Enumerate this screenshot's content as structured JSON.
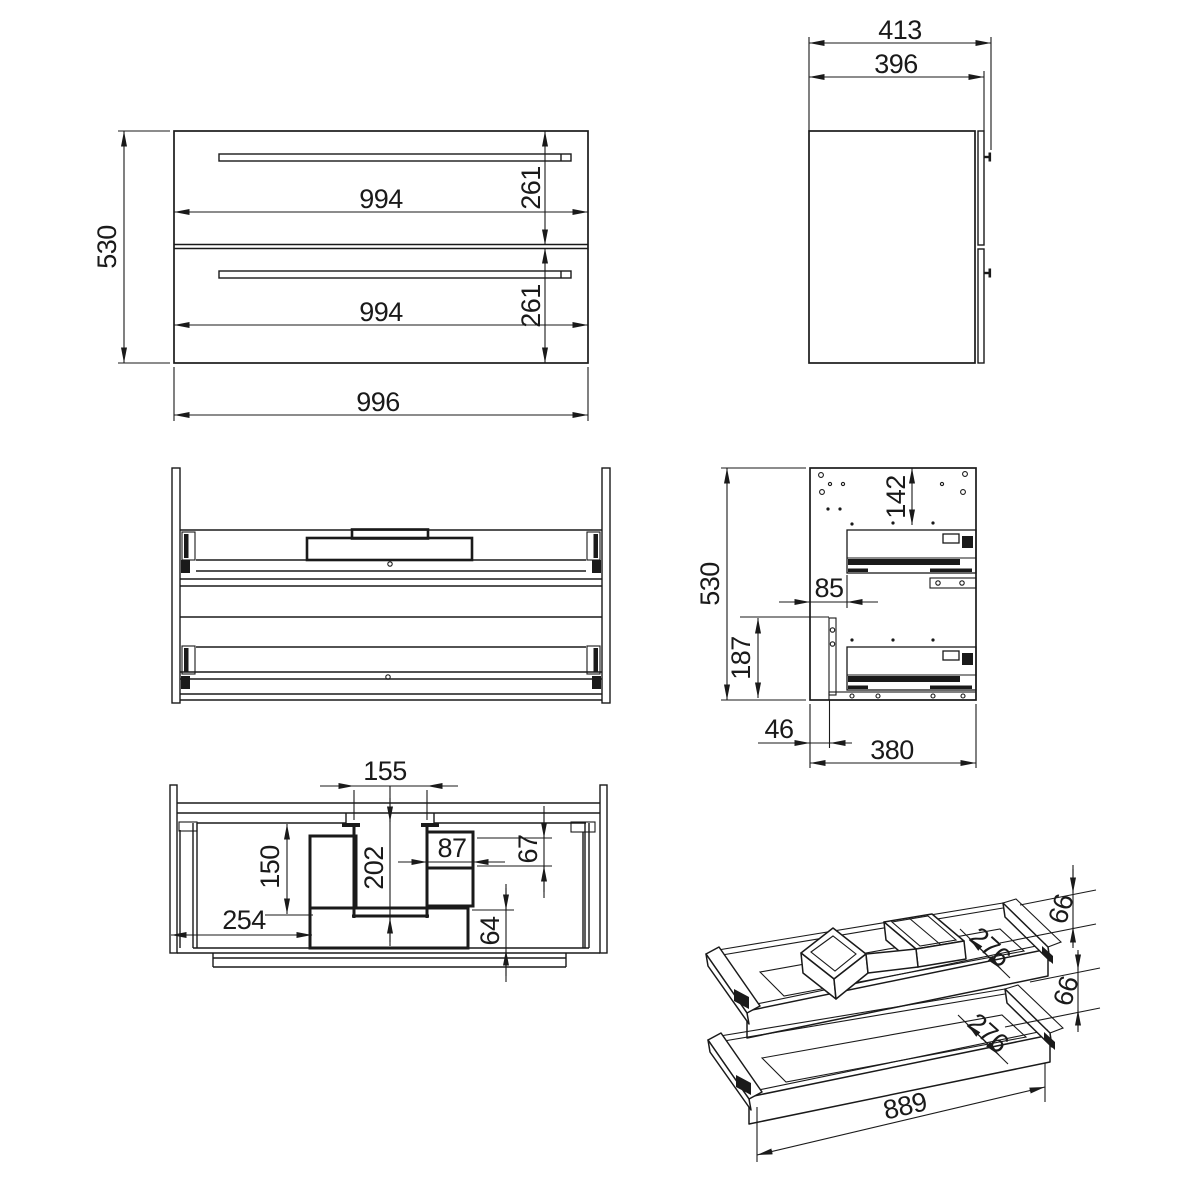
{
  "views": {
    "front": {
      "dims": {
        "height_total": "530",
        "drawer_top_width": "994",
        "drawer_top_height": "261",
        "drawer_bottom_width": "994",
        "drawer_bottom_height": "261",
        "width_total": "996"
      }
    },
    "side": {
      "dims": {
        "depth_with_handle": "413",
        "depth_body": "396"
      }
    },
    "side_section": {
      "dims": {
        "height_total": "530",
        "top_to_slide": "142",
        "slide_setback": "85",
        "lower_bracket_height": "187",
        "front_setback": "46",
        "depth_inner": "380"
      }
    },
    "plan": {
      "dims": {
        "cutout_width": "155",
        "cutout_depth": "202",
        "tray_box_width": "87",
        "right_clearance": "67",
        "left_box_depth": "150",
        "left_offset": "254",
        "back_box_depth": "64"
      }
    },
    "iso": {
      "dims": {
        "upper_wall_height": "66",
        "upper_inner_depth": "276",
        "lower_wall_height": "66",
        "lower_inner_depth": "276",
        "inner_length": "889"
      }
    }
  }
}
